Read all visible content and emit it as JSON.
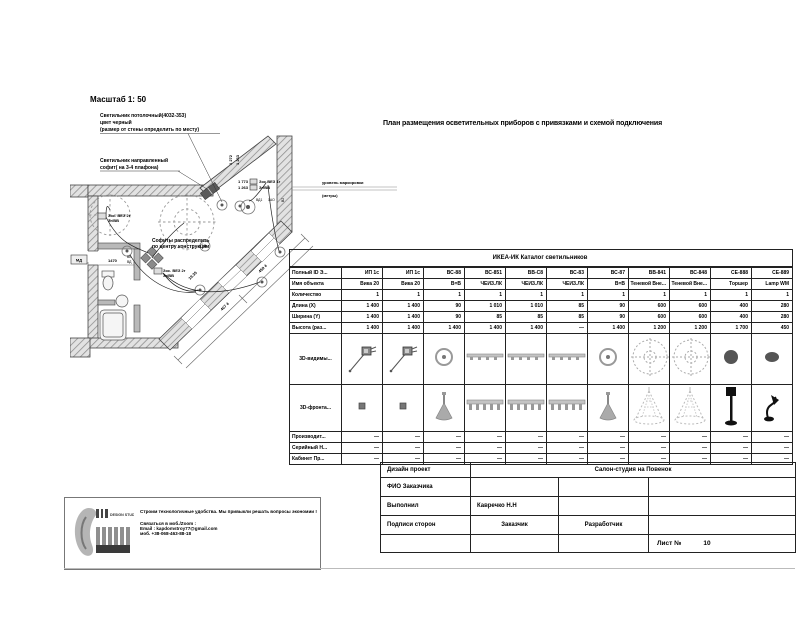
{
  "page": {
    "scale_label": "Масштаб 1: 50",
    "title": "План размещения осветительных приборов с привязками и схемой подключения"
  },
  "plan": {
    "annotations": {
      "fixture1_line1": "Светильник потолочный(4032-353)",
      "fixture1_line2": "цвет черный",
      "fixture1_line3": "(размер от стены определить по месту)",
      "fixture2_line1": "Светильник направленный",
      "fixture2_line2": "софит( на 3-4 плафона)",
      "center_note_line1": "Софиты распределить",
      "center_note_line2": "по центру конструкции",
      "level_note_line1": "уровень маркировки",
      "level_note_line2": "(метры)"
    },
    "labels": {
      "dim_1470": "1470",
      "dim_1272": "1 272",
      "dim_1263a": "1 263",
      "dim_1773": "1 773",
      "dim_1263b": "1 263",
      "dim_459": "459 4",
      "dim_407": "407 4",
      "dim_1935": "19.35",
      "socket1_line1": "Зос. ВЕЗ 2г",
      "socket1_line2": "Зг/ВВ",
      "socket2_line1": "Зос. ВЕЗ 2г",
      "socket2_line2": "Зг/ВВ",
      "socket3_line1": "Зос.ВЕЗ 1г",
      "socket3_line2": "Зг/ВВ",
      "md": "МД",
      "bb": "ВВ",
      "bd": "ВД",
      "bd1": "ВД1",
      "a1o": "1АО",
      "b2": "В2"
    }
  },
  "spec_table": {
    "title": "ИКЕА-ИК Каталог светильников",
    "rows": [
      {
        "label": "Полный ID Э...",
        "type": "text",
        "cells": [
          "ИП 1с",
          "ИП 1с",
          "ВС-88",
          "ВС-851",
          "ВВ-С8",
          "ВС-83",
          "ВС-87",
          "ВВ-841",
          "ВС-848",
          "СЕ-888",
          "СЕ-889"
        ]
      },
      {
        "label": "Имя объекта",
        "type": "text",
        "cells": [
          "Вика 20",
          "Вика 20",
          "В=В",
          "ЧЕИЗ.ЛК",
          "ЧЕИЗ.ЛК",
          "ЧЕИЗ.ЛК",
          "В=В",
          "Теневой Вне...",
          "Теневой Вне...",
          "Торшер",
          "Lamp WM"
        ]
      },
      {
        "label": "Количество",
        "type": "text",
        "cells": [
          "1",
          "1",
          "1",
          "1",
          "1",
          "1",
          "1",
          "1",
          "1",
          "1",
          "1"
        ]
      },
      {
        "label": "Длина (X)",
        "type": "text",
        "cells": [
          "1 400",
          "1 400",
          "90",
          "1 010",
          "1 010",
          "85",
          "90",
          "600",
          "600",
          "400",
          "280"
        ]
      },
      {
        "label": "Ширина (Y)",
        "type": "text",
        "cells": [
          "1 400",
          "1 400",
          "90",
          "85",
          "85",
          "85",
          "90",
          "600",
          "600",
          "400",
          "280"
        ]
      },
      {
        "label": "Высота (раз...",
        "type": "text",
        "cells": [
          "1 400",
          "1 400",
          "1 400",
          "1 400",
          "1 400",
          "—",
          "1 400",
          "1 200",
          "1 200",
          "1 700",
          "450"
        ]
      },
      {
        "label": "3D-видимы...",
        "type": "icon",
        "cells": [
          "spotlight",
          "spotlight",
          "downlight",
          "track",
          "track",
          "track",
          "downlight",
          "chandelier-top",
          "chandelier-top",
          "sphere",
          "sphere-small"
        ]
      },
      {
        "label": "3D-фронта...",
        "type": "icon2",
        "cells": [
          "square",
          "square",
          "table-lamp",
          "track-front",
          "track-front",
          "track-front",
          "table-lamp",
          "tree-cone",
          "tree-cone",
          "floor-lamp",
          "desk-lamp"
        ]
      },
      {
        "label": "Производит...",
        "type": "text",
        "cells": [
          "—",
          "—",
          "—",
          "—",
          "—",
          "—",
          "—",
          "—",
          "—",
          "—",
          "—"
        ]
      },
      {
        "label": "Серийный Н...",
        "type": "text",
        "cells": [
          "—",
          "—",
          "—",
          "—",
          "—",
          "—",
          "—",
          "—",
          "—",
          "—",
          "—"
        ]
      },
      {
        "label": "Кабинет Пр...",
        "type": "text",
        "cells": [
          "—",
          "—",
          "—",
          "—",
          "—",
          "—",
          "—",
          "—",
          "—",
          "—",
          "—"
        ]
      }
    ]
  },
  "title_block": {
    "design_project": "Дизайн проект",
    "project_name": "Салон-студия на Повенок",
    "fio_label": "ФИО Заказчика",
    "done_label": "Выполнил",
    "done_value": "Кавречко Н.Н",
    "signs_label": "Подписи сторон",
    "customer_label": "Заказчик",
    "developer_label": "Разработчик",
    "sheet_label": "Лист №",
    "sheet_number": "10"
  },
  "footer": {
    "logo_caption": "DESIGN STUDIO",
    "tagline": "Строим технологичные удобства.     Мы привыкли решать вопросы экономии !",
    "contact_line1": "Связаться в моб./Zoom :",
    "contact_line2": "Email : kapdomstroy77@gmail.com",
    "contact_line3": "моб. +38-068-463-88-18"
  },
  "colors": {
    "wall_hatch": "#909090",
    "fixture_gray": "#8a8a8a",
    "accent_black": "#111111"
  }
}
